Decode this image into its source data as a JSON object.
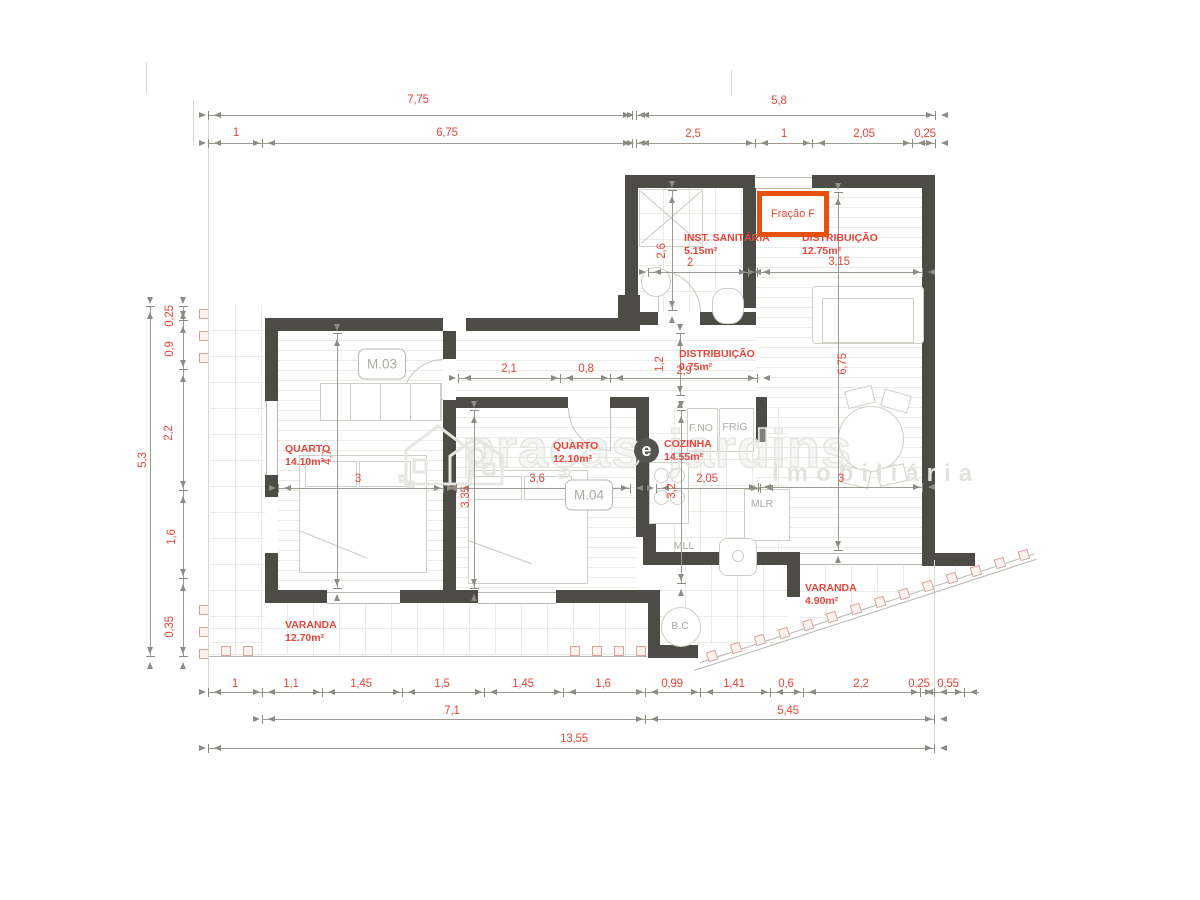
{
  "badge": {
    "text": "Fração F"
  },
  "watermark": {
    "word1": "praças",
    "circle_letter": "e",
    "word2": "jardins",
    "subtitle": "imobiliária"
  },
  "rooms": [
    {
      "id": "quarto-1",
      "name": "QUARTO",
      "area": "14.10m²",
      "x": 285,
      "y": 443
    },
    {
      "id": "quarto-2",
      "name": "QUARTO",
      "area": "12.10m²",
      "x": 553,
      "y": 440
    },
    {
      "id": "cozinha",
      "name": "COZINHA",
      "area": "14.55m²",
      "x": 664,
      "y": 438
    },
    {
      "id": "inst-sanitaria",
      "name": "INST. SANITÁRIA",
      "area": "5.15m²",
      "x": 684,
      "y": 232
    },
    {
      "id": "distribuicao-1",
      "name": "DISTRIBUIÇÃO",
      "area": "12.75m²",
      "x": 802,
      "y": 232
    },
    {
      "id": "distribuicao-2",
      "name": "DISTRIBUIÇÃO",
      "area": "0.75m²",
      "x": 679,
      "y": 348
    },
    {
      "id": "varanda-1",
      "name": "VARANDA",
      "area": "12.70m²",
      "x": 285,
      "y": 619
    },
    {
      "id": "varanda-2",
      "name": "VARANDA",
      "area": "4.90m²",
      "x": 805,
      "y": 582
    }
  ],
  "fixture_labels": [
    {
      "text": "M.03",
      "x": 382,
      "y": 364,
      "boxed": true
    },
    {
      "text": "M.04",
      "x": 589,
      "y": 495,
      "boxed": true
    },
    {
      "text": "F.NO",
      "x": 701,
      "y": 428
    },
    {
      "text": "FRIG",
      "x": 735,
      "y": 427
    },
    {
      "text": "MLR",
      "x": 762,
      "y": 504
    },
    {
      "text": "MLL",
      "x": 684,
      "y": 546
    },
    {
      "text": "B.C",
      "x": 680,
      "y": 626
    }
  ],
  "dimensions": [
    {
      "t": "7,75",
      "x": 418,
      "y": 100
    },
    {
      "t": "5,8",
      "x": 779,
      "y": 101
    },
    {
      "t": "1",
      "x": 236,
      "y": 133
    },
    {
      "t": "6,75",
      "x": 447,
      "y": 133
    },
    {
      "t": "2,5",
      "x": 693,
      "y": 134
    },
    {
      "t": "1",
      "x": 784,
      "y": 134
    },
    {
      "t": "2,05",
      "x": 864,
      "y": 134
    },
    {
      "t": "0,25",
      "x": 925,
      "y": 134
    },
    {
      "t": "5,3",
      "x": 143,
      "y": 460,
      "r": 1
    },
    {
      "t": "0,25",
      "x": 170,
      "y": 316,
      "r": 1
    },
    {
      "t": "0,9",
      "x": 170,
      "y": 349,
      "r": 1
    },
    {
      "t": "2,2",
      "x": 169,
      "y": 433,
      "r": 1
    },
    {
      "t": "1,6",
      "x": 172,
      "y": 537,
      "r": 1
    },
    {
      "t": "0,35",
      "x": 170,
      "y": 627,
      "r": 1
    },
    {
      "t": "1",
      "x": 235,
      "y": 684
    },
    {
      "t": "1,1",
      "x": 291,
      "y": 684
    },
    {
      "t": "1,45",
      "x": 361,
      "y": 684
    },
    {
      "t": "1,5",
      "x": 442,
      "y": 684
    },
    {
      "t": "1,45",
      "x": 523,
      "y": 684
    },
    {
      "t": "1,6",
      "x": 603,
      "y": 684
    },
    {
      "t": "0,99",
      "x": 672,
      "y": 684
    },
    {
      "t": "1,41",
      "x": 734,
      "y": 684
    },
    {
      "t": "0,6",
      "x": 786,
      "y": 684
    },
    {
      "t": "2,2",
      "x": 861,
      "y": 684
    },
    {
      "t": "0,25",
      "x": 919,
      "y": 684
    },
    {
      "t": "0,55",
      "x": 948,
      "y": 684
    },
    {
      "t": "7,1",
      "x": 452,
      "y": 711
    },
    {
      "t": "5,45",
      "x": 788,
      "y": 711
    },
    {
      "t": "13,55",
      "x": 574,
      "y": 739
    },
    {
      "t": "2,6",
      "x": 662,
      "y": 251,
      "r": 1
    },
    {
      "t": "2",
      "x": 690,
      "y": 263
    },
    {
      "t": "3,15",
      "x": 839,
      "y": 262
    },
    {
      "t": "2,1",
      "x": 509,
      "y": 369
    },
    {
      "t": "0,8",
      "x": 586,
      "y": 369
    },
    {
      "t": "2,9",
      "x": 684,
      "y": 371
    },
    {
      "t": "1,2",
      "x": 660,
      "y": 364,
      "r": 1
    },
    {
      "t": "6,75",
      "x": 843,
      "y": 364,
      "r": 1
    },
    {
      "t": "3",
      "x": 841,
      "y": 479
    },
    {
      "t": "4,7",
      "x": 328,
      "y": 457,
      "r": 1
    },
    {
      "t": "3",
      "x": 358,
      "y": 479
    },
    {
      "t": "3,35",
      "x": 466,
      "y": 497,
      "r": 1
    },
    {
      "t": "3,6",
      "x": 537,
      "y": 479
    },
    {
      "t": "3,2",
      "x": 672,
      "y": 491,
      "r": 1
    },
    {
      "t": "2,05",
      "x": 707,
      "y": 479
    }
  ],
  "dim_lines": [
    {
      "x": 208,
      "y": 115,
      "len": 424,
      "ticks": [
        0,
        424
      ]
    },
    {
      "x": 636,
      "y": 115,
      "len": 299,
      "ticks": [
        0,
        299
      ]
    },
    {
      "x": 208,
      "y": 143,
      "len": 424,
      "ticks": [
        0,
        54,
        424
      ]
    },
    {
      "x": 636,
      "y": 143,
      "len": 299,
      "ticks": [
        0,
        119,
        176,
        276,
        299
      ]
    },
    {
      "x": 648,
      "y": 272,
      "len": 100,
      "ticks": [
        0,
        100
      ]
    },
    {
      "x": 757,
      "y": 272,
      "len": 165,
      "ticks": [
        0,
        165
      ]
    },
    {
      "x": 458,
      "y": 378,
      "len": 299,
      "ticks": [
        0,
        102,
        152,
        299
      ]
    },
    {
      "x": 278,
      "y": 488,
      "len": 165,
      "ticks": [
        0,
        165
      ]
    },
    {
      "x": 456,
      "y": 488,
      "len": 174,
      "ticks": [
        0,
        174
      ]
    },
    {
      "x": 656,
      "y": 488,
      "len": 104,
      "ticks": [
        0,
        104
      ]
    },
    {
      "x": 758,
      "y": 487,
      "len": 164,
      "ticks": [
        0,
        164
      ]
    },
    {
      "x": 208,
      "y": 692,
      "len": 771,
      "ticks": [
        0,
        54,
        114,
        194,
        276,
        355,
        437,
        492,
        562,
        595,
        712,
        726,
        756
      ]
    },
    {
      "x": 262,
      "y": 719,
      "len": 672,
      "ticks": [
        0,
        383,
        672
      ]
    },
    {
      "x": 208,
      "y": 748,
      "len": 726,
      "ticks": [
        0,
        726
      ]
    },
    {
      "x": 150,
      "y": 306,
      "len": 350,
      "v": 1,
      "ticks": [
        0,
        350
      ]
    },
    {
      "x": 183,
      "y": 306,
      "len": 350,
      "v": 1,
      "ticks": [
        0,
        14,
        63,
        184,
        272,
        350
      ]
    },
    {
      "x": 672,
      "y": 190,
      "len": 120,
      "v": 1,
      "ticks": [
        0,
        120
      ]
    },
    {
      "x": 680,
      "y": 333,
      "len": 62,
      "v": 1,
      "ticks": [
        0,
        62
      ]
    },
    {
      "x": 838,
      "y": 192,
      "len": 358,
      "v": 1,
      "ticks": [
        0,
        358
      ]
    },
    {
      "x": 337,
      "y": 333,
      "len": 255,
      "v": 1,
      "ticks": [
        0,
        255
      ]
    },
    {
      "x": 474,
      "y": 410,
      "len": 178,
      "v": 1,
      "ticks": [
        0,
        178
      ]
    },
    {
      "x": 681,
      "y": 410,
      "len": 173,
      "v": 1,
      "ticks": [
        0,
        173
      ]
    }
  ],
  "plan": {
    "walls": [
      [
        625,
        175,
        130,
        13
      ],
      [
        812,
        175,
        123,
        13
      ],
      [
        922,
        188,
        13,
        365
      ],
      [
        922,
        553,
        53,
        13
      ],
      [
        625,
        188,
        13,
        143
      ],
      [
        743,
        188,
        13,
        120
      ],
      [
        618,
        295,
        22,
        36
      ],
      [
        638,
        312,
        20,
        13
      ],
      [
        700,
        312,
        56,
        13
      ],
      [
        265,
        318,
        178,
        13
      ],
      [
        466,
        318,
        172,
        13
      ],
      [
        265,
        331,
        13,
        70
      ],
      [
        265,
        475,
        13,
        22
      ],
      [
        265,
        553,
        13,
        50
      ],
      [
        265,
        590,
        62,
        13
      ],
      [
        400,
        590,
        78,
        13
      ],
      [
        556,
        590,
        104,
        13
      ],
      [
        443,
        331,
        13,
        28
      ],
      [
        443,
        400,
        13,
        190
      ],
      [
        456,
        397,
        112,
        11
      ],
      [
        610,
        397,
        26,
        11
      ],
      [
        636,
        397,
        13,
        140
      ],
      [
        756,
        397,
        11,
        45
      ],
      [
        643,
        520,
        13,
        45
      ],
      [
        655,
        552,
        145,
        13
      ],
      [
        787,
        552,
        13,
        45
      ],
      [
        648,
        590,
        12,
        68
      ],
      [
        648,
        645,
        50,
        13
      ]
    ],
    "floors": [
      {
        "x": 278,
        "y": 331,
        "w": 165,
        "h": 259,
        "kind": "planks"
      },
      {
        "x": 456,
        "y": 408,
        "w": 180,
        "h": 182,
        "kind": "planks"
      },
      {
        "x": 456,
        "y": 331,
        "w": 300,
        "h": 66,
        "kind": "planks"
      },
      {
        "x": 756,
        "y": 188,
        "w": 166,
        "h": 364,
        "kind": "planks"
      },
      {
        "x": 638,
        "y": 188,
        "w": 105,
        "h": 124,
        "kind": "grid"
      },
      {
        "x": 649,
        "y": 408,
        "w": 138,
        "h": 144,
        "kind": "grid"
      },
      {
        "x": 210,
        "y": 305,
        "w": 55,
        "h": 350,
        "kind": "grid"
      },
      {
        "x": 210,
        "y": 603,
        "w": 438,
        "h": 52,
        "kind": "grid"
      },
      {
        "x": 660,
        "y": 565,
        "w": 127,
        "h": 78,
        "kind": "grid"
      },
      {
        "x": 800,
        "y": 566,
        "w": 160,
        "h": 74,
        "kind": "grid vr"
      }
    ],
    "windows": [
      [
        266,
        401,
        10,
        74
      ],
      [
        327,
        592,
        73,
        10
      ],
      [
        478,
        592,
        78,
        10
      ],
      [
        800,
        553,
        122,
        10
      ],
      [
        755,
        177,
        57,
        10
      ]
    ],
    "ext_lines": [
      [
        208,
        112,
        1,
        578
      ],
      [
        934,
        560,
        1,
        186
      ],
      [
        146,
        62,
        1,
        31
      ],
      [
        731,
        70,
        1,
        26
      ],
      [
        193,
        100,
        1,
        46
      ]
    ],
    "rail_lines": [
      {
        "x": 209,
        "y": 305,
        "len": 352,
        "ang": 90
      },
      {
        "x": 209,
        "y": 656,
        "len": 438,
        "ang": 0
      },
      {
        "x": 700,
        "y": 662,
        "len": 352,
        "ang": -18
      },
      {
        "x": 694,
        "y": 670,
        "len": 360,
        "ang": -18
      }
    ],
    "railing_squares": [
      {
        "x": 204,
        "y": 314
      },
      {
        "x": 204,
        "y": 336
      },
      {
        "x": 204,
        "y": 358
      },
      {
        "x": 204,
        "y": 610
      },
      {
        "x": 204,
        "y": 632
      },
      {
        "x": 204,
        "y": 654
      },
      {
        "x": 226,
        "y": 651
      },
      {
        "x": 248,
        "y": 651
      },
      {
        "x": 575,
        "y": 651
      },
      {
        "x": 597,
        "y": 651
      },
      {
        "x": 619,
        "y": 651
      },
      {
        "x": 641,
        "y": 651
      },
      {
        "x": 712,
        "y": 656,
        "rot": -18
      },
      {
        "x": 736,
        "y": 648,
        "rot": -18
      },
      {
        "x": 760,
        "y": 640,
        "rot": -18
      },
      {
        "x": 784,
        "y": 633,
        "rot": -18
      },
      {
        "x": 808,
        "y": 625,
        "rot": -18
      },
      {
        "x": 832,
        "y": 617,
        "rot": -18
      },
      {
        "x": 856,
        "y": 609,
        "rot": -18
      },
      {
        "x": 880,
        "y": 602,
        "rot": -18
      },
      {
        "x": 904,
        "y": 594,
        "rot": -18
      },
      {
        "x": 928,
        "y": 586,
        "rot": -18
      },
      {
        "x": 952,
        "y": 578,
        "rot": -18
      },
      {
        "x": 976,
        "y": 571,
        "rot": -18
      },
      {
        "x": 1000,
        "y": 563,
        "rot": -18
      },
      {
        "x": 1024,
        "y": 555,
        "rot": -18
      }
    ]
  },
  "colors": {
    "wall": "#4c4b45",
    "dimension_text": "#e8463c",
    "badge_border": "#e8500e",
    "fixture_text": "#a9aba3",
    "floor_line": "#e9ebe5",
    "furniture_line": "#ccd0c7",
    "railing_square": "#dba39a"
  }
}
